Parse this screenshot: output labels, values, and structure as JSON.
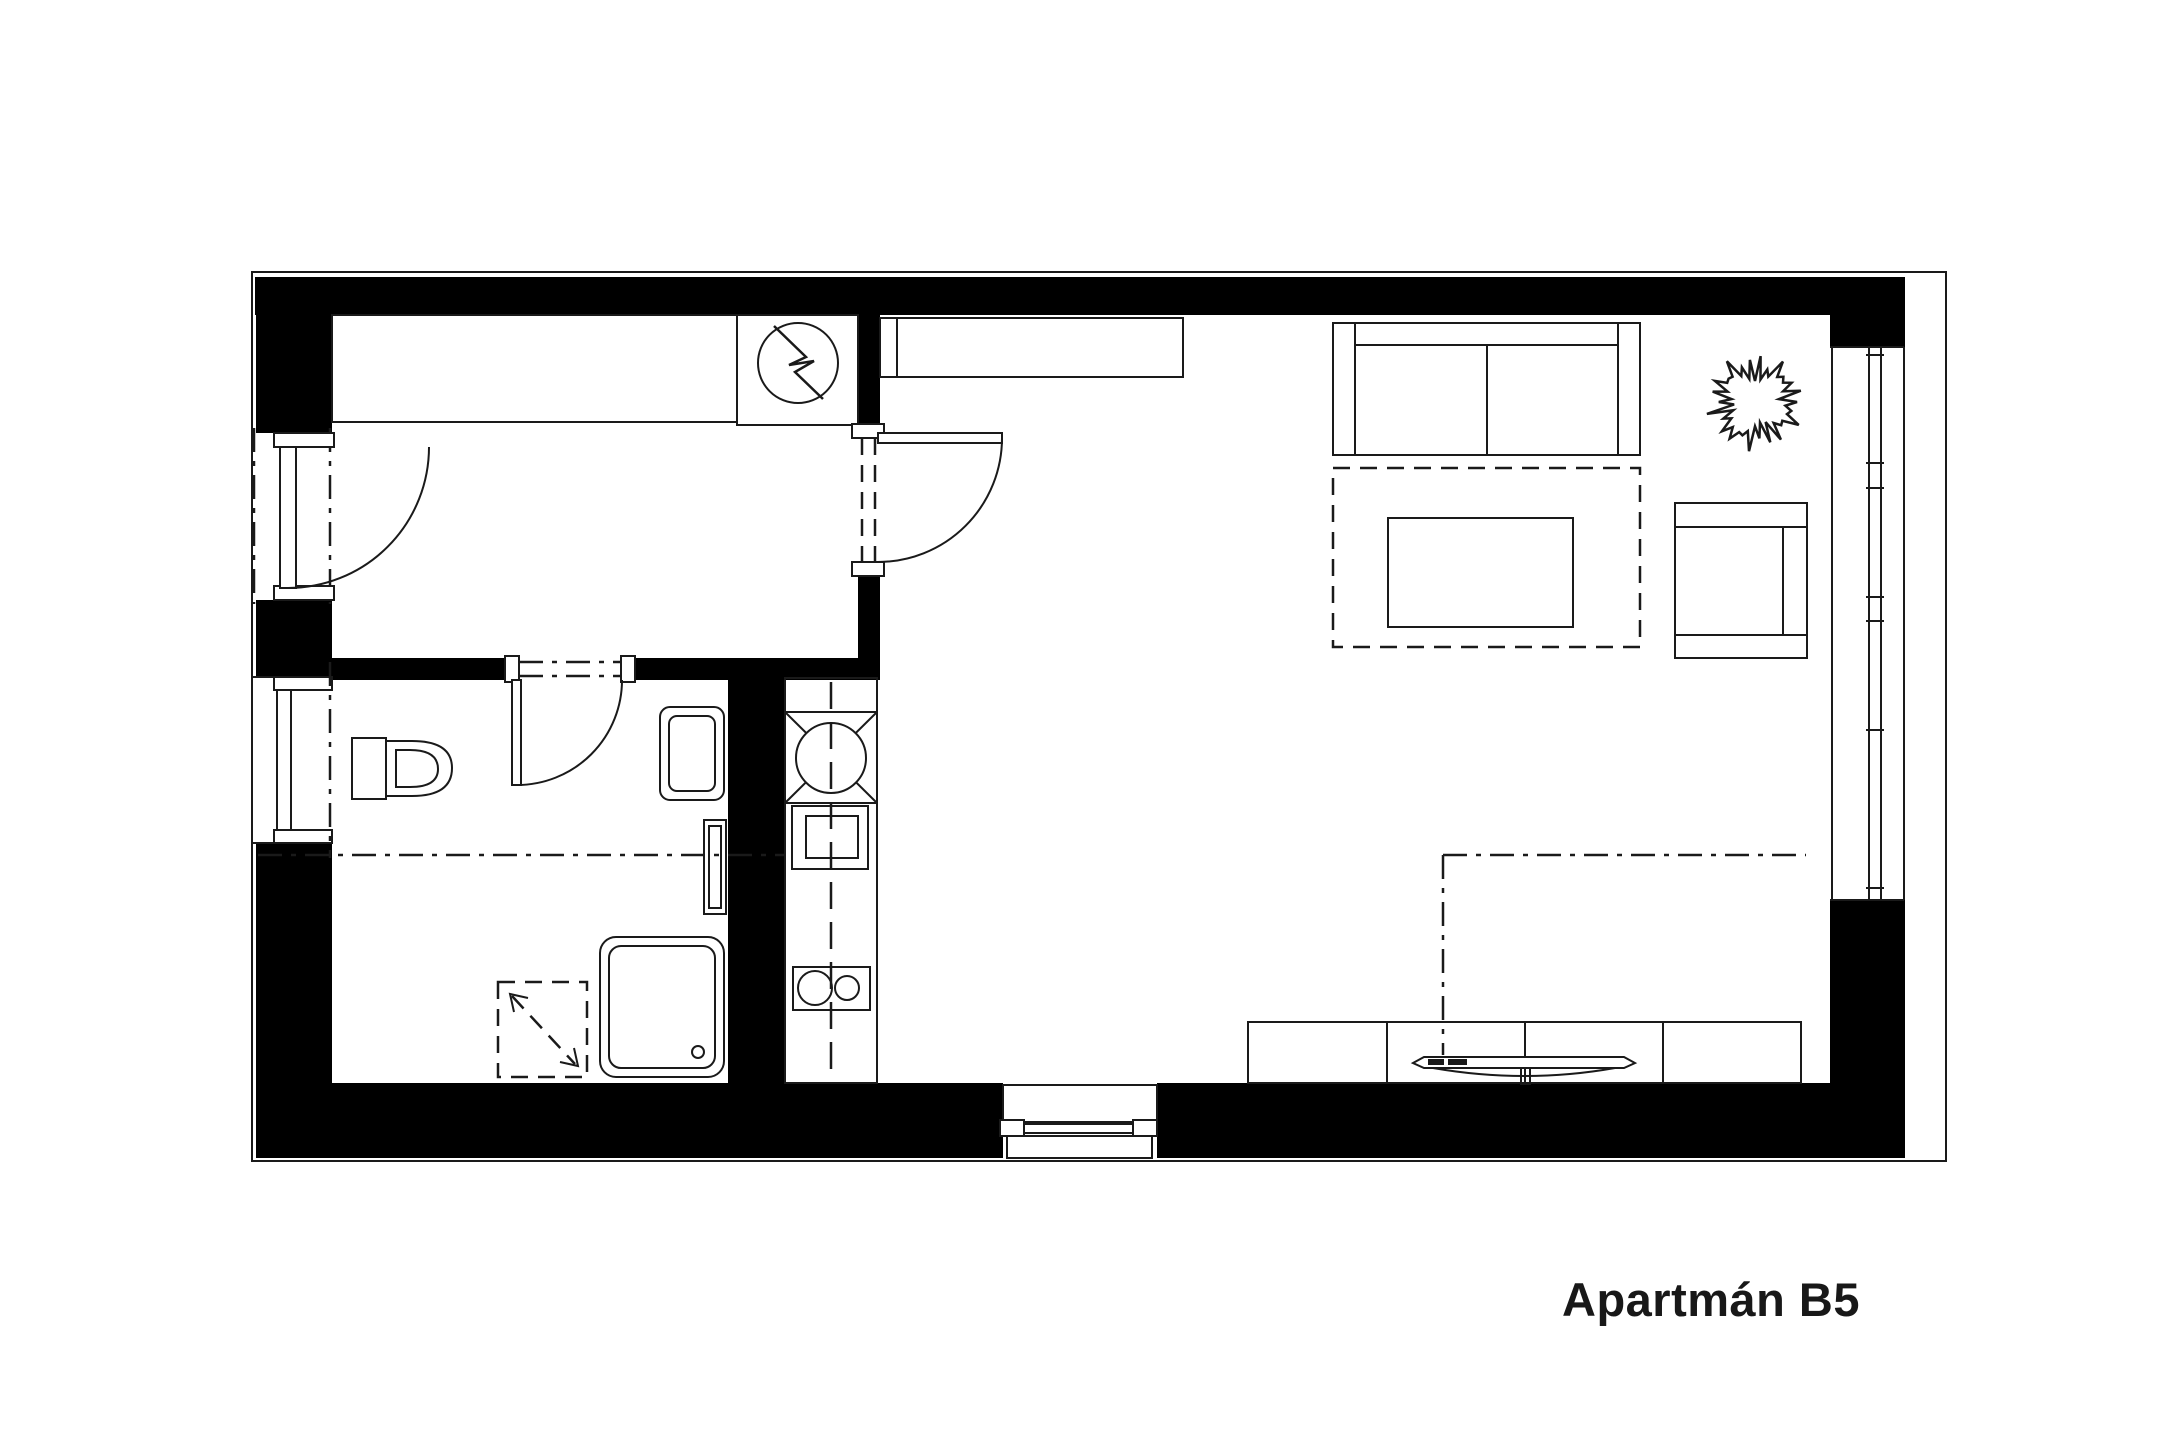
{
  "title": "Apartmán B5",
  "colors": {
    "background": "#ffffff",
    "wall": "#000000",
    "line": "#1a1a1a"
  },
  "plan_elements": {
    "fixtures": [
      "entry-door",
      "built-in-wardrobe",
      "electrical-closet",
      "lightning-symbol",
      "hall-living-door",
      "bathroom-door",
      "toilet",
      "washbasin",
      "towel-radiator",
      "washing-machine",
      "shower-tray",
      "kitchenette-counter",
      "kitchen-sink",
      "cooktop",
      "hob-burners",
      "bathroom-window",
      "panoramic-window",
      "balcony-door",
      "sofa",
      "rug",
      "coffee-table",
      "plant",
      "armchair",
      "wall-sofa",
      "folding-table",
      "sideboard",
      "loft-outline"
    ]
  }
}
